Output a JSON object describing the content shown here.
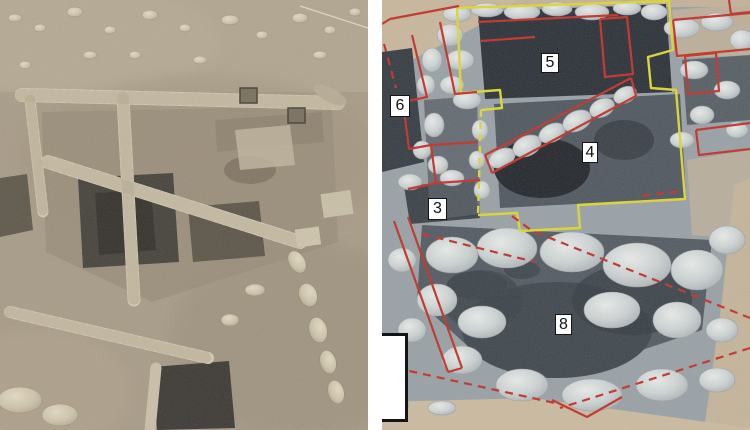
{
  "figure": {
    "type": "aerial-photo-pair",
    "panels": {
      "left": {
        "name": "Aerial orthophoto of excavated stone structure in sandy terrain"
      },
      "right": {
        "name": "Annotated close-up orthophoto of excavation with wall outlines",
        "area_labels": [
          {
            "id": "area-5",
            "text": "5"
          },
          {
            "id": "area-6",
            "text": "6"
          },
          {
            "id": "area-4",
            "text": "4"
          },
          {
            "id": "area-3",
            "text": "3"
          },
          {
            "id": "area-8",
            "text": "8"
          }
        ],
        "annotation_colors": {
          "red_wall_outline": "#c23128",
          "yellow_structure_outline": "#ded631"
        }
      }
    }
  }
}
